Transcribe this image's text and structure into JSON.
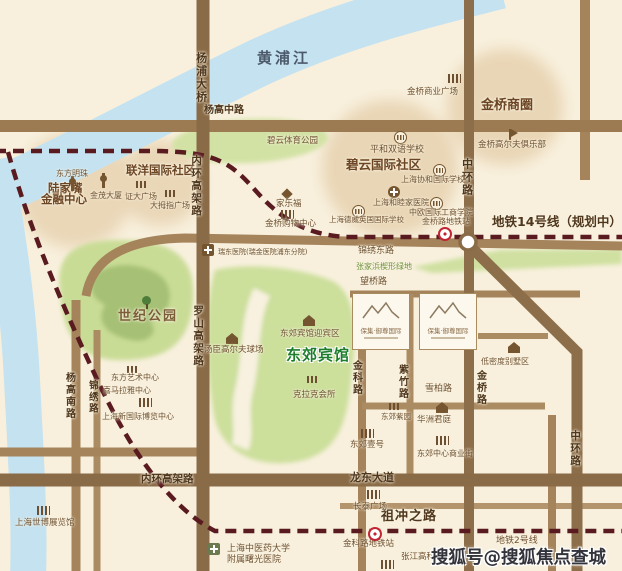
{
  "areas": {
    "huangpu": "黄浦江",
    "century_park": "世纪公园",
    "zhangjiabang": "张家浜楔形绿地",
    "biyun_sports": "碧云体育公园",
    "dongjiao_hotel": "东郊宾馆",
    "biyun_intl": "碧云国际社区",
    "lianyang_intl": "联洋国际社区",
    "lujiazui_1": "陆家嘴",
    "lujiazui_2": "金融中心",
    "jinqiao_biz": "金桥商圈"
  },
  "roads": {
    "yangpu_bridge": "杨浦大桥",
    "inner_ring_v": "内环高架路",
    "inner_ring_h": "内环高架路",
    "luoshan": "罗山高架路",
    "zhonghuan_n": "中环路",
    "zhonghuan_s": "中环路",
    "yanggao_m": "杨高中路",
    "yanggao_s": "杨高南路",
    "jinxiu": "锦绣路",
    "jinxiu_e": "锦绣东路",
    "wangqiao": "望桥路",
    "jinke": "金科路",
    "zizhu": "紫竹路",
    "jinqiao": "金桥路",
    "xuebai": "雪柏路",
    "longdong": "龙东大道",
    "zuchongzhi": "祖冲之路"
  },
  "metro": {
    "line14": "地铁14号线（规划中）",
    "line2": "地铁2号线",
    "jinqiao_station": "金桥路地铁站",
    "jinke_station": "金科路地铁站"
  },
  "pois": {
    "oriental_pearl": "东方明珠",
    "jinmao_tower": "金茂大厦",
    "zhengda_plaza": "证大广场",
    "thumb_plaza": "大拇指广场",
    "jinqiao_biz_plaza": "金桥商业广场",
    "jinqiao_golf": "金桥高尔夫俱乐部",
    "pinghe_school": "平和双语学校",
    "concordia_school": "上海协和国际学校",
    "united_family": "上海和睦家医院",
    "ceibs": "中欧国际工商学院",
    "carrefour": "家乐福",
    "jinqiao_mall": "金桥购物中心",
    "dulwich_school": "上海德威英国国际学校",
    "ruidong_hospital": "瑞东医院(瑞金医院浦东分院)",
    "tangchen_golf": "汤臣高尔夫球场",
    "dongjiao_reception": "东郊宾馆迎宾区",
    "kelake_club": "克拉克会所",
    "dongfang_art": "东方艺术中心",
    "himalaya_center": "喜马拉雅中心",
    "expo_intl": "上海新国际博览中心",
    "expo_exhibition": "上海世博展览馆",
    "villa_area": "低密度别墅区",
    "huazhou_junting": "华洲君庭",
    "dongjiao_ziyuan": "东郊紫园",
    "dongjiao_one": "东郊壹号",
    "dongjiao_center": "东郊中心商业街",
    "changtai_plaza": "长泰广场",
    "zhangjiang_plaza": "张江高科广场",
    "shuguang_1": "上海中医药大学",
    "shuguang_2": "附属曙光医院"
  },
  "estates": {
    "box1": "保集·御尊国际",
    "box2": "保集·御尊国际"
  },
  "watermark": "搜狐号@搜狐焦点查城站",
  "colors": {
    "background": "#f8f0dd",
    "road_major": "#8d6e4a",
    "road_minor": "#a5845c",
    "river": "#c5e2f0",
    "park_green": "#ccdf9b",
    "metro_dash": "#5a1b20",
    "hotel_green": "#1d7d2c",
    "district_circle": "#ead7b8"
  }
}
